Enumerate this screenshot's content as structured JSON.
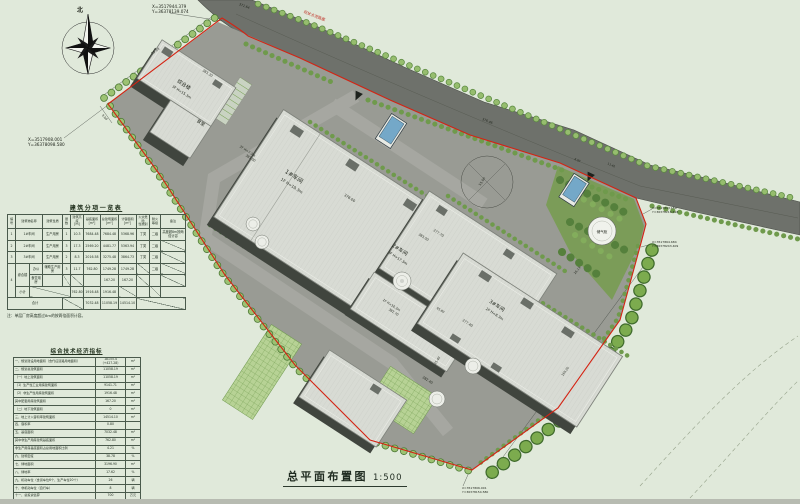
{
  "title_block": {
    "title": "总平面布置图",
    "scale": "1:500"
  },
  "compass": {
    "label": "北"
  },
  "tables": {
    "building_list": {
      "title": "建筑分项一览表",
      "note": "注：单层厂房高度超过8m的按两倍面积计容。",
      "header": [
        {
          "t": "编号"
        },
        {
          "t": "建筑物名称",
          "cs": 2
        },
        {
          "t": "建筑性质"
        },
        {
          "t": "层数"
        },
        {
          "t": "建筑高度\n[m]"
        },
        {
          "t": "基底面积\n[m²]"
        },
        {
          "t": "总建筑面积\n[m²]"
        },
        {
          "t": "计容面积\n[m²]"
        },
        {
          "t": "火灾危险\n性类别"
        },
        {
          "t": "耐火\n等级"
        },
        {
          "t": "备注"
        }
      ],
      "rows": [
        [
          {
            "t": "1"
          },
          {
            "t": "1#车间",
            "cs": 2
          },
          {
            "t": "生产用房"
          },
          {
            "t": "1"
          },
          {
            "t": "10.3"
          },
          {
            "t": "7684.48"
          },
          {
            "t": "7684.48"
          },
          {
            "t": "5368.96"
          },
          {
            "t": "丁类"
          },
          {
            "t": "二级"
          },
          {
            "t": "高度超8m按两倍计容",
            "rs": 1
          }
        ],
        [
          {
            "t": "2"
          },
          {
            "t": "2#车间",
            "cs": 2
          },
          {
            "t": "生产用房"
          },
          {
            "t": "3"
          },
          {
            "t": "17.3"
          },
          {
            "t": "2569.20"
          },
          {
            "t": "4481.77"
          },
          {
            "t": "5363.94"
          },
          {
            "t": "丁类"
          },
          {
            "t": "二级"
          },
          {
            "d": 1
          }
        ],
        [
          {
            "t": "3"
          },
          {
            "t": "3#车间",
            "cs": 2
          },
          {
            "t": "生产用房"
          },
          {
            "t": "2"
          },
          {
            "t": "8.3"
          },
          {
            "t": "2016.58"
          },
          {
            "t": "3275.48"
          },
          {
            "t": "3864.73"
          },
          {
            "t": "丁类"
          },
          {
            "t": "二级"
          },
          {
            "d": 1
          }
        ],
        [
          {
            "t": "4",
            "rs": 3
          },
          {
            "t": "综合楼",
            "rs": 2
          },
          {
            "t": "办公"
          },
          {
            "t": "辅助生产用房"
          },
          {
            "t": "3"
          },
          {
            "t": "11.7"
          },
          {
            "t": "762.80"
          },
          {
            "t": "1749.28"
          },
          {
            "t": "1749.28"
          },
          {
            "d": 1
          },
          {
            "t": "二级"
          },
          {
            "d": 1
          }
        ],
        [
          {
            "t": "食堂用房"
          },
          {
            "t": ""
          },
          {
            "d": 1
          },
          {
            "d": 1
          },
          {
            "t": ""
          },
          {
            "t": "167.20"
          },
          {
            "t": "167.20"
          },
          {
            "d": 1
          },
          {
            "t": ""
          },
          {
            "d": 1
          }
        ],
        [
          {
            "t": "小计"
          },
          {
            "d": 1,
            "cs": 3
          },
          {
            "t": "762.80"
          },
          {
            "t": "1916.48"
          },
          {
            "t": "1916.48"
          },
          {
            "d": 1
          },
          {
            "t": ""
          },
          {
            "d": 1
          }
        ],
        [
          {
            "t": "合计",
            "cs": 4
          },
          {
            "d": 1,
            "cs": 2
          },
          {
            "t": "7032.48"
          },
          {
            "t": "11058.19"
          },
          {
            "t": "14514.10"
          },
          {
            "d": 1,
            "cs": 3
          }
        ]
      ]
    },
    "indicators": {
      "title": "综合技术经济指标",
      "rows": [
        [
          "一、规划建设用地面积（含代征道路用地面积）",
          "18155.4（+427.28）",
          "m²"
        ],
        [
          "二、规划总建筑面积",
          "11058.19",
          "m²"
        ],
        [
          "（一）地上建筑面积",
          "11058.19",
          "m²"
        ],
        [
          "（1）生产性工业用房建筑面积",
          "9141.71",
          "m²"
        ],
        [
          "（2）非生产性用房建筑面积",
          "1916.48",
          "m²"
        ],
        [
          "其中配套用房建筑面积",
          "167.20",
          "m²"
        ],
        [
          "（二）地下建筑面积",
          "0",
          "m²"
        ],
        [
          "三、地上计入容积率建筑面积",
          "14514.10",
          "m²"
        ],
        [
          "四、容积率",
          "0.80",
          ""
        ],
        [
          "五、基底面积",
          "7032.48",
          "m²"
        ],
        [
          "其中非生产用房建筑基底面积",
          "762.80",
          "m²"
        ],
        [
          "非生产用房基底面积占总用地面积比例",
          "4.21",
          "%"
        ],
        [
          "六、建筑密度",
          "38.78",
          "%"
        ],
        [
          "七、绿地面积",
          "3196.90",
          "m²"
        ],
        [
          "八、绿地率",
          "17.62",
          "%"
        ],
        [
          "九、机动车位（含货车位6个、生产车位20个）",
          "26",
          "辆"
        ],
        [
          "十、非机动车位（自行车）",
          "8",
          "辆"
        ],
        [
          "十一、总投资估算",
          "700",
          "万元"
        ],
        [
          {
            "t": "十二、日照分析：厂区内均为非日照需求建筑，对周边建筑日照无不利影响。",
            "cs": 3,
            "al": "left"
          }
        ]
      ]
    }
  },
  "plan": {
    "colors": {
      "paper": "#e0e9da",
      "road": "#6e716b",
      "paving": "#999b94",
      "roof": "#d8dbd4",
      "wall": "#40453e",
      "lawn": "#7b9c58",
      "hedge": "#9cc272",
      "boundary_red": "#d42313",
      "blue_structure": "#74a8c8"
    },
    "texts": [
      {
        "t": "北",
        "x": 80,
        "y": 12,
        "s": 6,
        "w": "bold"
      },
      {
        "t": "X=3517944.379",
        "x": 152,
        "y": 8,
        "s": 4.2,
        "a": "start"
      },
      {
        "t": "Y=36378139.074",
        "x": 152,
        "y": 13,
        "s": 4.2,
        "a": "start"
      },
      {
        "t": "X=3517908.001",
        "x": 28,
        "y": 141,
        "s": 4.2,
        "a": "start"
      },
      {
        "t": "Y=36378098.580",
        "x": 28,
        "y": 146,
        "s": 4.2,
        "a": "start"
      },
      {
        "t": "现状水泥路面",
        "x": 314,
        "y": 17,
        "s": 3.8,
        "r": 21,
        "c": "#c03026"
      },
      {
        "t": "371.64",
        "x": 244,
        "y": 7,
        "s": 3.2,
        "r": 21
      },
      {
        "t": "376.46",
        "x": 487,
        "y": 122,
        "s": 3.2,
        "r": 23
      },
      {
        "t": "8.00",
        "x": 577,
        "y": 161,
        "s": 2.8,
        "r": 23
      },
      {
        "t": "11.40",
        "x": 611,
        "y": 166,
        "s": 2.8,
        "r": 23
      },
      {
        "t": "综合楼",
        "x": 183,
        "y": 86,
        "s": 5,
        "r": 33
      },
      {
        "t": "3F H=15.3m",
        "x": 181,
        "y": 93,
        "s": 3.5,
        "r": 33
      },
      {
        "t": "食堂",
        "x": 200,
        "y": 124,
        "s": 4.5,
        "r": 33
      },
      {
        "t": "383.30",
        "x": 207,
        "y": 74,
        "s": 3.3,
        "r": 33
      },
      {
        "t": "2F H=7.3m",
        "x": 247,
        "y": 152,
        "s": 3.2,
        "r": 33
      },
      {
        "t": "383.00",
        "x": 250,
        "y": 159,
        "s": 3.2,
        "r": 33
      },
      {
        "t": "1#车间",
        "x": 293,
        "y": 178,
        "s": 5.8,
        "r": 33
      },
      {
        "t": "1F H=10.3m",
        "x": 291,
        "y": 187,
        "s": 4,
        "r": 33
      },
      {
        "t": "378.00",
        "x": 349,
        "y": 199,
        "s": 3.6,
        "r": 33
      },
      {
        "t": "383.00",
        "x": 423,
        "y": 238,
        "s": 3.3,
        "r": 33
      },
      {
        "t": "2#车间",
        "x": 399,
        "y": 251,
        "s": 5,
        "r": 33
      },
      {
        "t": "3F H=17.3m",
        "x": 397,
        "y": 259,
        "s": 3.6,
        "r": 33
      },
      {
        "t": "377.70",
        "x": 438,
        "y": 234,
        "s": 3.4,
        "r": 33
      },
      {
        "t": "1F H=10.3m",
        "x": 391,
        "y": 306,
        "s": 3.2,
        "r": 33
      },
      {
        "t": "382.70",
        "x": 393,
        "y": 313,
        "s": 3.2,
        "r": 33
      },
      {
        "t": "3#车间",
        "x": 496,
        "y": 307,
        "s": 5,
        "r": 33
      },
      {
        "t": "2F H=8.3m",
        "x": 494,
        "y": 315,
        "s": 3.6,
        "r": 33
      },
      {
        "t": "377.40",
        "x": 467,
        "y": 324,
        "s": 3.4,
        "r": 33
      },
      {
        "t": "382.40",
        "x": 427,
        "y": 381,
        "s": 3.4,
        "r": 33
      },
      {
        "t": "储气柜",
        "x": 602,
        "y": 233,
        "s": 3.6
      },
      {
        "t": "15.00",
        "x": 483,
        "y": 182,
        "s": 3.3,
        "r": -57
      },
      {
        "t": "55.10",
        "x": 156,
        "y": 52,
        "s": 3.3,
        "r": -36
      },
      {
        "t": "9.00",
        "x": 104,
        "y": 118,
        "s": 3,
        "r": 47
      },
      {
        "t": "26.13",
        "x": 578,
        "y": 271,
        "s": 3,
        "r": -51
      },
      {
        "t": "65.80",
        "x": 440,
        "y": 311,
        "s": 3,
        "r": 33
      },
      {
        "t": "25.40",
        "x": 438,
        "y": 361,
        "s": 3,
        "r": -57
      },
      {
        "t": "169.20",
        "x": 566,
        "y": 372,
        "s": 3,
        "r": -54
      },
      {
        "t": "X=3517893.159",
        "x": 652,
        "y": 209,
        "s": 3,
        "a": "start"
      },
      {
        "t": "Y=36378216.618",
        "x": 652,
        "y": 213,
        "s": 3,
        "a": "start"
      },
      {
        "t": "X=3517864.684",
        "x": 652,
        "y": 243,
        "s": 3,
        "a": "start"
      },
      {
        "t": "Y=36378243.409",
        "x": 652,
        "y": 247,
        "s": 3,
        "a": "start"
      },
      {
        "t": "X=3517806.001",
        "x": 462,
        "y": 489,
        "s": 3,
        "a": "start"
      },
      {
        "t": "Y=36378154.580",
        "x": 462,
        "y": 493,
        "s": 3,
        "a": "start"
      }
    ]
  }
}
